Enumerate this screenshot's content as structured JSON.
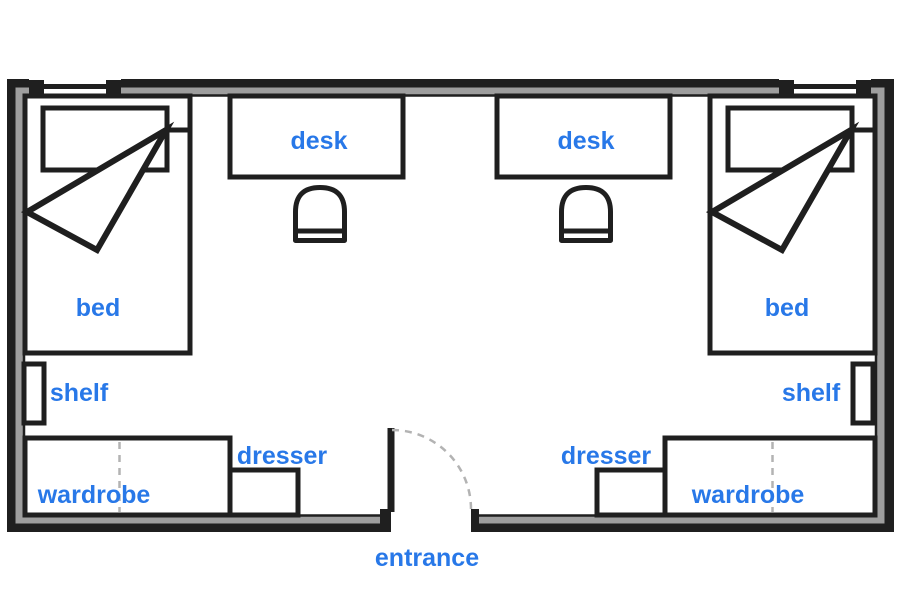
{
  "floor_plan": {
    "type": "dorm-double-room-floor-plan",
    "labels": {
      "desk_left": "desk",
      "desk_right": "desk",
      "bed_left": "bed",
      "bed_right": "bed",
      "shelf_left": "shelf",
      "shelf_right": "shelf",
      "dresser_left": "dresser",
      "dresser_right": "dresser",
      "wardrobe_left": "wardrobe",
      "wardrobe_right": "wardrobe",
      "entrance": "entrance"
    },
    "colors": {
      "wall_outline": "#1f1f1f",
      "wall_core": "#9e9e9e",
      "furniture_outline": "#1f1f1f",
      "label_text": "#2878e8",
      "dashed_lines": "#b3b3b3",
      "background": "#ffffff"
    }
  }
}
